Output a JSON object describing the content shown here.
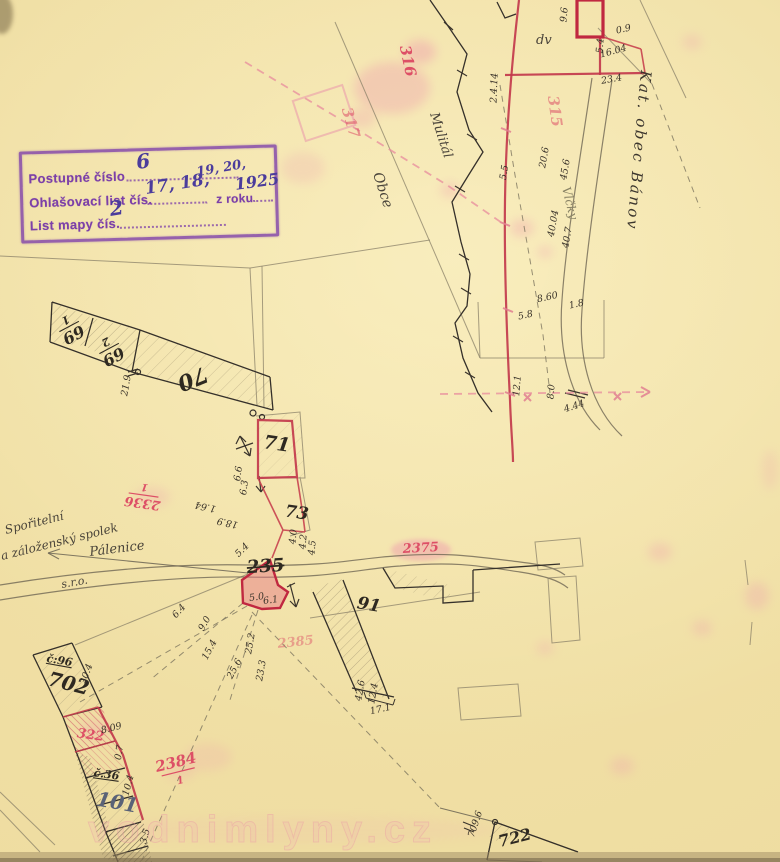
{
  "stamp": {
    "row1_label": "Postupné číslo",
    "row1_value": "6",
    "row2_label": "Ohlašovací list čís.",
    "row2_value": "17, 18,",
    "row2_value_sup": "19, 20,",
    "row2_suffix": "z roku",
    "row2_year": "1925",
    "row3_label": "List mapy čís.",
    "row3_value": "2"
  },
  "places": {
    "district": "Kat. obec Bánov",
    "mulital": "Mulitál",
    "obce": "Obce",
    "vlcky": "Vlčky",
    "palenice": "Pálenice",
    "assoc1": "Spořitelní",
    "assoc2": "a záloženský spolek",
    "assoc3": "s.r.o.",
    "house96": "č:96",
    "house36": "č.36",
    "dv": "dv"
  },
  "parcels": {
    "p69_num": "69",
    "p69_den": "1",
    "p69b_num": "69",
    "p69b_den": "2",
    "p70": "70",
    "p71": "71",
    "p73": "73",
    "p91": "91",
    "p235": "235",
    "p702": "702",
    "p101": "101",
    "p722": "722"
  },
  "red_numbers": {
    "r316": "316",
    "r317": "317",
    "r315": "315",
    "r2336_num": "2336",
    "r2336_den": "1",
    "r2375": "2375",
    "r2385": "2385",
    "r2384_num": "2384",
    "r2384_den": "1",
    "r322": "322"
  },
  "measurements": {
    "top": {
      "t1": "2.4.14",
      "t2": "9.6",
      "t3": "5.4",
      "t4": "0.9",
      "t5": "16.04",
      "t6": "23.4",
      "t7": "20.6",
      "t8": "45.6",
      "t9": "5.5",
      "t10": "40.04",
      "t11": "40.7",
      "t12": "8.60",
      "t13": "1.8",
      "t14": "5.8",
      "t15": "12.1",
      "t16": "8.0",
      "t17": "4.44"
    },
    "mid": {
      "m1": "21.9",
      "m2": "1.64",
      "m3": "18.9",
      "m4": "6.6",
      "m5": "6.3",
      "m6": "5.4",
      "m7": "4.0",
      "m8": "4.2",
      "m9": "4.5",
      "m10": "5.0",
      "m11": "6.1",
      "m12": "6.4",
      "m13": "9.0",
      "m14": "15.4",
      "m15": "25.2",
      "m16": "25.6",
      "m17": "23.3",
      "m18": "42.6",
      "m19": "12.4",
      "m20": "17.1"
    },
    "bottom": {
      "b1": "20.4",
      "b2": "8.09",
      "b3": "0.7",
      "b4": "10.4",
      "b5": "3.5",
      "b6": "709.6"
    }
  },
  "watermark": "vodnimlyny.cz",
  "colors": {
    "paper": "#f0dfa3",
    "stamp_ink": "#7c40a8",
    "handwriting_ink": "#4b3c9c",
    "red_ink": "#c23a4c",
    "pink_ink": "#ec94a8",
    "black_ink": "#35302a",
    "pencil": "#8a8068"
  }
}
